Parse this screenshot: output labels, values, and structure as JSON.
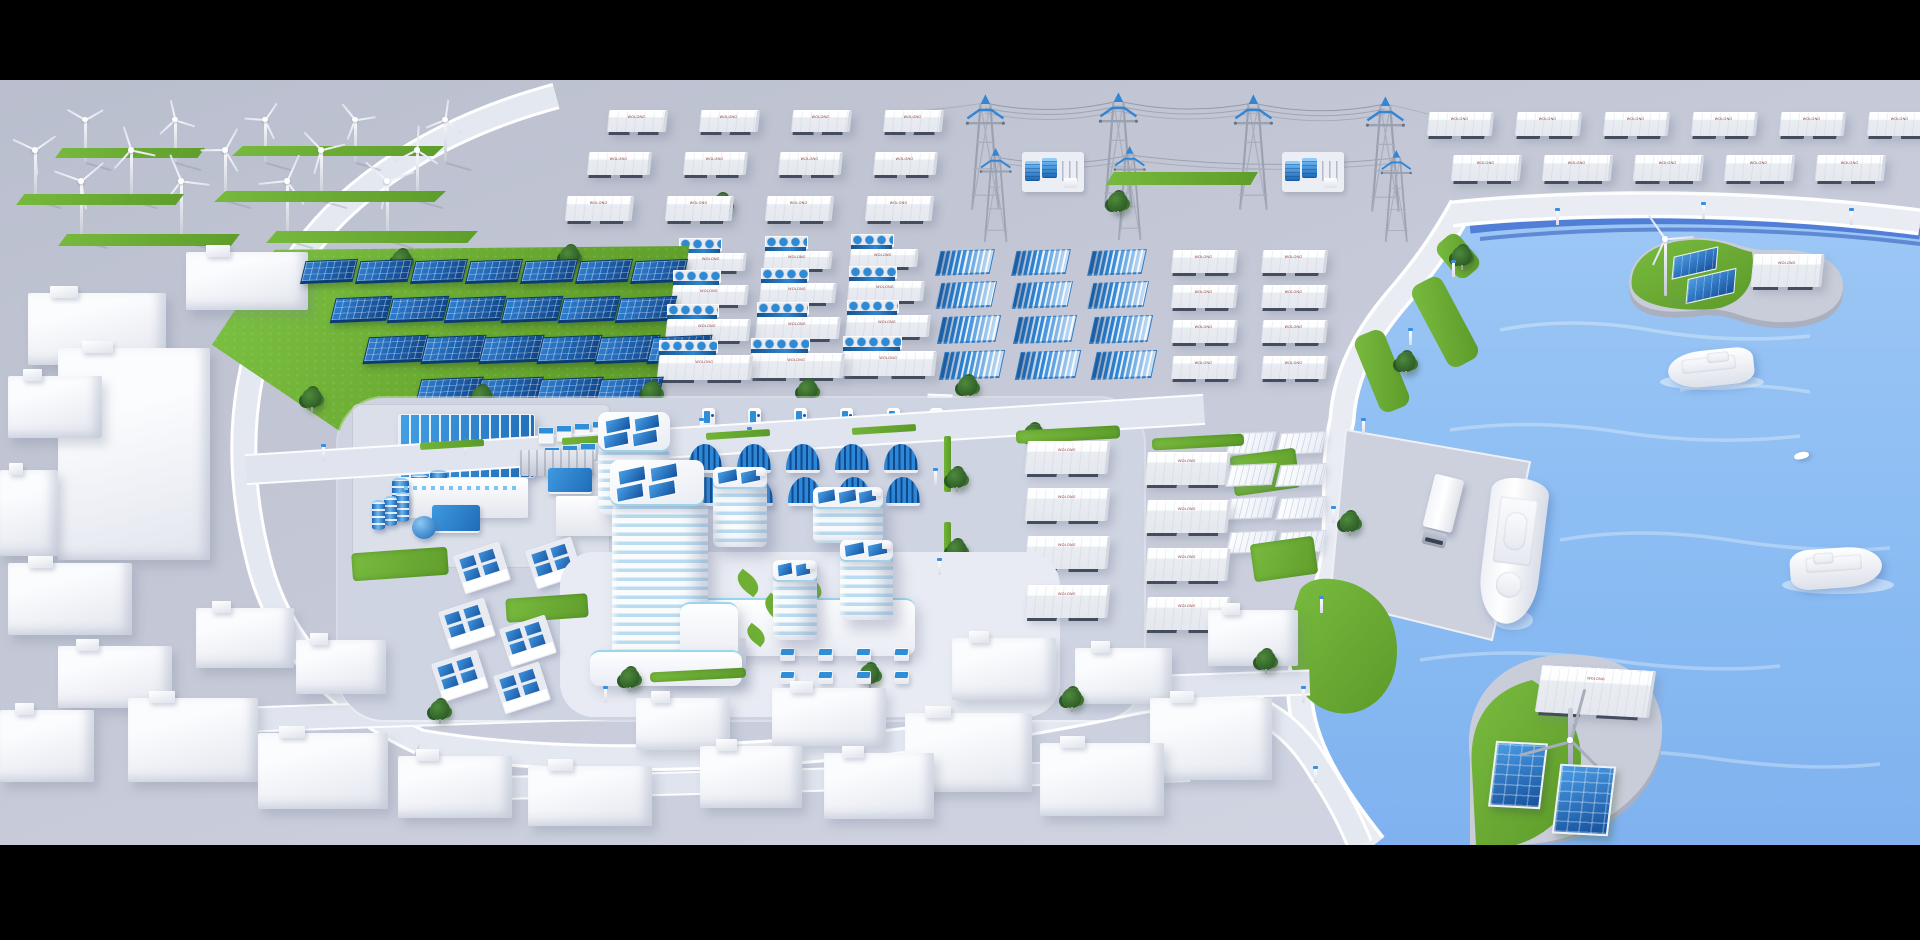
{
  "meta": {
    "title": "Zero-carbon smart energy city - 3D isometric render",
    "letterbox": true,
    "width": 1920,
    "height": 940
  },
  "labels": {
    "container": "WOLONG"
  },
  "colors": {
    "letterbox": "#000000",
    "ground": "#c3c7d5",
    "road": "#e0e4ee",
    "curb": "#ffffff",
    "grass": "#6fae33",
    "panel_blue": "#1d6fc0",
    "panel_dark": "#0d3d7a",
    "accent_blue": "#2e8fd8",
    "glass_blue": "#badcf0",
    "water": "#8fc0f3",
    "water_deep": "#3f6cd0",
    "white_building": "#f4f5f9",
    "steel": "#99a0b0",
    "tree_green": "#36682c",
    "label_red": "#8a3030"
  },
  "regions": {
    "wind_farm": {
      "turbines": 14,
      "grass_strips": 6
    },
    "north_container_yard": {
      "containers": 12,
      "label": "WOLONG"
    },
    "transmission_corridor": {
      "pylons": 7,
      "substations": 2,
      "power_lines": 5
    },
    "northeast_container_yard": {
      "containers": 11,
      "label": "WOLONG"
    },
    "solar_farm": {
      "panels": 23,
      "rows": [
        7,
        6,
        6,
        4
      ]
    },
    "battery_storage": {
      "bess_units": 12,
      "label": "WOLONG"
    },
    "gradient_pv_arrays": {
      "arrays": 12
    },
    "upper_container_yard": {
      "containers": 8,
      "label": "WOLONG"
    },
    "white_pv_arrays": {
      "arrays": 8
    },
    "campus": {
      "tower_roof_panels": 8,
      "office_blocks": 4,
      "pv_houses": 6,
      "ev_chargers": 6,
      "solar_carports": 10,
      "plaza_stations": 8,
      "factory": {
        "large_tanks": 3,
        "small_tanks": 3,
        "sphere_tank": 1,
        "cooling_units": 8
      }
    },
    "east_container_yard": {
      "containers": 8,
      "label": "WOLONG"
    },
    "harbor": {
      "islands": [
        {
          "name": "island-north",
          "features": [
            "wind-turbine",
            "solar-panels",
            "storage-container"
          ],
          "label": "WOLONG"
        },
        {
          "name": "island-south",
          "features": [
            "wind-turbine",
            "solar-panels",
            "storage-container"
          ],
          "label": "WOLONG"
        }
      ],
      "ships": 3,
      "small_boats": 1,
      "trucks": 1
    },
    "city": {
      "buildings": 25,
      "trees": 20,
      "street_lamps": 21
    }
  }
}
